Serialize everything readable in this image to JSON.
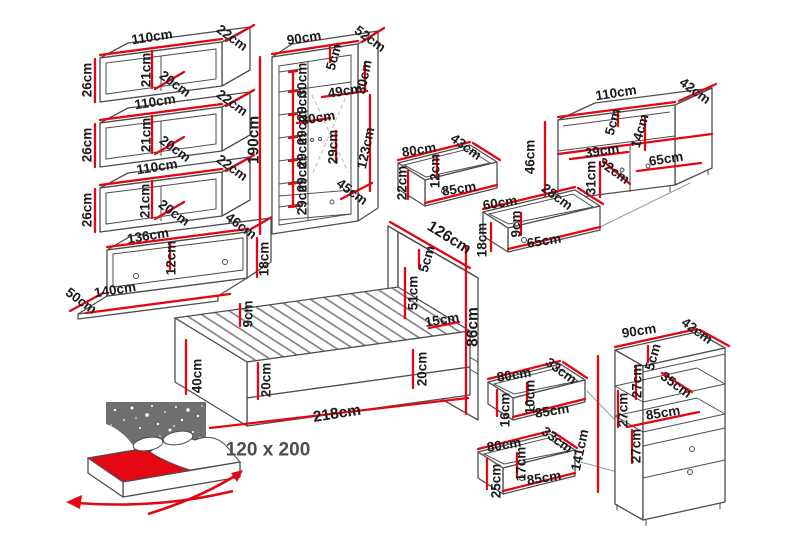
{
  "unit": "cm",
  "colors": {
    "dimension_line": "#e30613",
    "outline": "#4e4e4e",
    "label_text": "#1b1b1b",
    "size_label_text": "#4e4e4e",
    "star_panel": "#6f6f6f",
    "mattress": "#e30613"
  },
  "pieces": {
    "wall_shelf_1": {
      "width": "110cm",
      "depth": "22cm",
      "height": "26cm",
      "inner_height": "21cm",
      "inner_depth": "20cm"
    },
    "wall_shelf_2": {
      "width": "110cm",
      "depth": "22cm",
      "height": "26cm",
      "inner_height": "21cm",
      "inner_depth": "20cm"
    },
    "wall_shelf_3": {
      "width": "110cm",
      "depth": "22cm",
      "height": "26cm",
      "inner_height": "21cm",
      "inner_depth": "20cm"
    },
    "wall_drawer": {
      "width": "136cm",
      "depth": "46cm",
      "inner_height": "12cm",
      "height": "18cm",
      "outer_width": "140cm",
      "outer_depth": "50cm"
    },
    "wardrobe": {
      "width": "90cm",
      "depth": "52cm",
      "height": "190cm",
      "top_edge": "5cm",
      "top_section": "30cm",
      "rail_width": "49cm",
      "shelf_width": "30cm",
      "mid_gap": "29cm",
      "shelf_gaps": [
        "30cm",
        "29cm",
        "29cm",
        "29cm",
        "29cm",
        "29cm"
      ],
      "hanging_height": "123cm",
      "inner_depth": "45cm"
    },
    "tv_stand": {
      "width": "110cm",
      "depth": "42cm",
      "height": "46cm",
      "top_edge": "5cm",
      "niche_height": "14cm",
      "left_section": "39cm",
      "inner_depth": "32cm",
      "inner_height": "31cm",
      "right_section": "65cm"
    },
    "drawer_80x43": {
      "width": "80cm",
      "depth": "43cm",
      "inner_height": "12cm",
      "height": "22cm",
      "outer_width": "85cm"
    },
    "drawer_60x28": {
      "width": "60cm",
      "depth": "28cm",
      "inner_height": "9cm",
      "height": "18cm",
      "outer_width": "65cm"
    },
    "bed": {
      "headboard_width": "126cm",
      "headboard_edge": "5cm",
      "headboard_height": "51cm",
      "shelf_depth": "15cm",
      "total_height": "86cm",
      "slat_height": "9cm",
      "frame_height": "40cm",
      "base_height": "20cm",
      "headboard_base": "20cm",
      "length": "218cm",
      "mattress_size": "120 x 200"
    },
    "drawer_80x33_top": {
      "width": "80cm",
      "depth": "33cm",
      "inner_height": "10cm",
      "height": "16cm",
      "outer_width": "85cm"
    },
    "drawer_80x33_bottom": {
      "width": "80cm",
      "depth": "33cm",
      "inner_height": "17cm",
      "height": "25cm",
      "outer_width": "85cm"
    },
    "bookcase": {
      "height": "141cm",
      "width": "90cm",
      "depth": "42cm",
      "top_edge": "5cm",
      "gap_1": "27cm",
      "shelf_depth": "35cm",
      "gap_2": "27cm",
      "inner_width": "85cm",
      "gap_3": "27cm"
    }
  }
}
